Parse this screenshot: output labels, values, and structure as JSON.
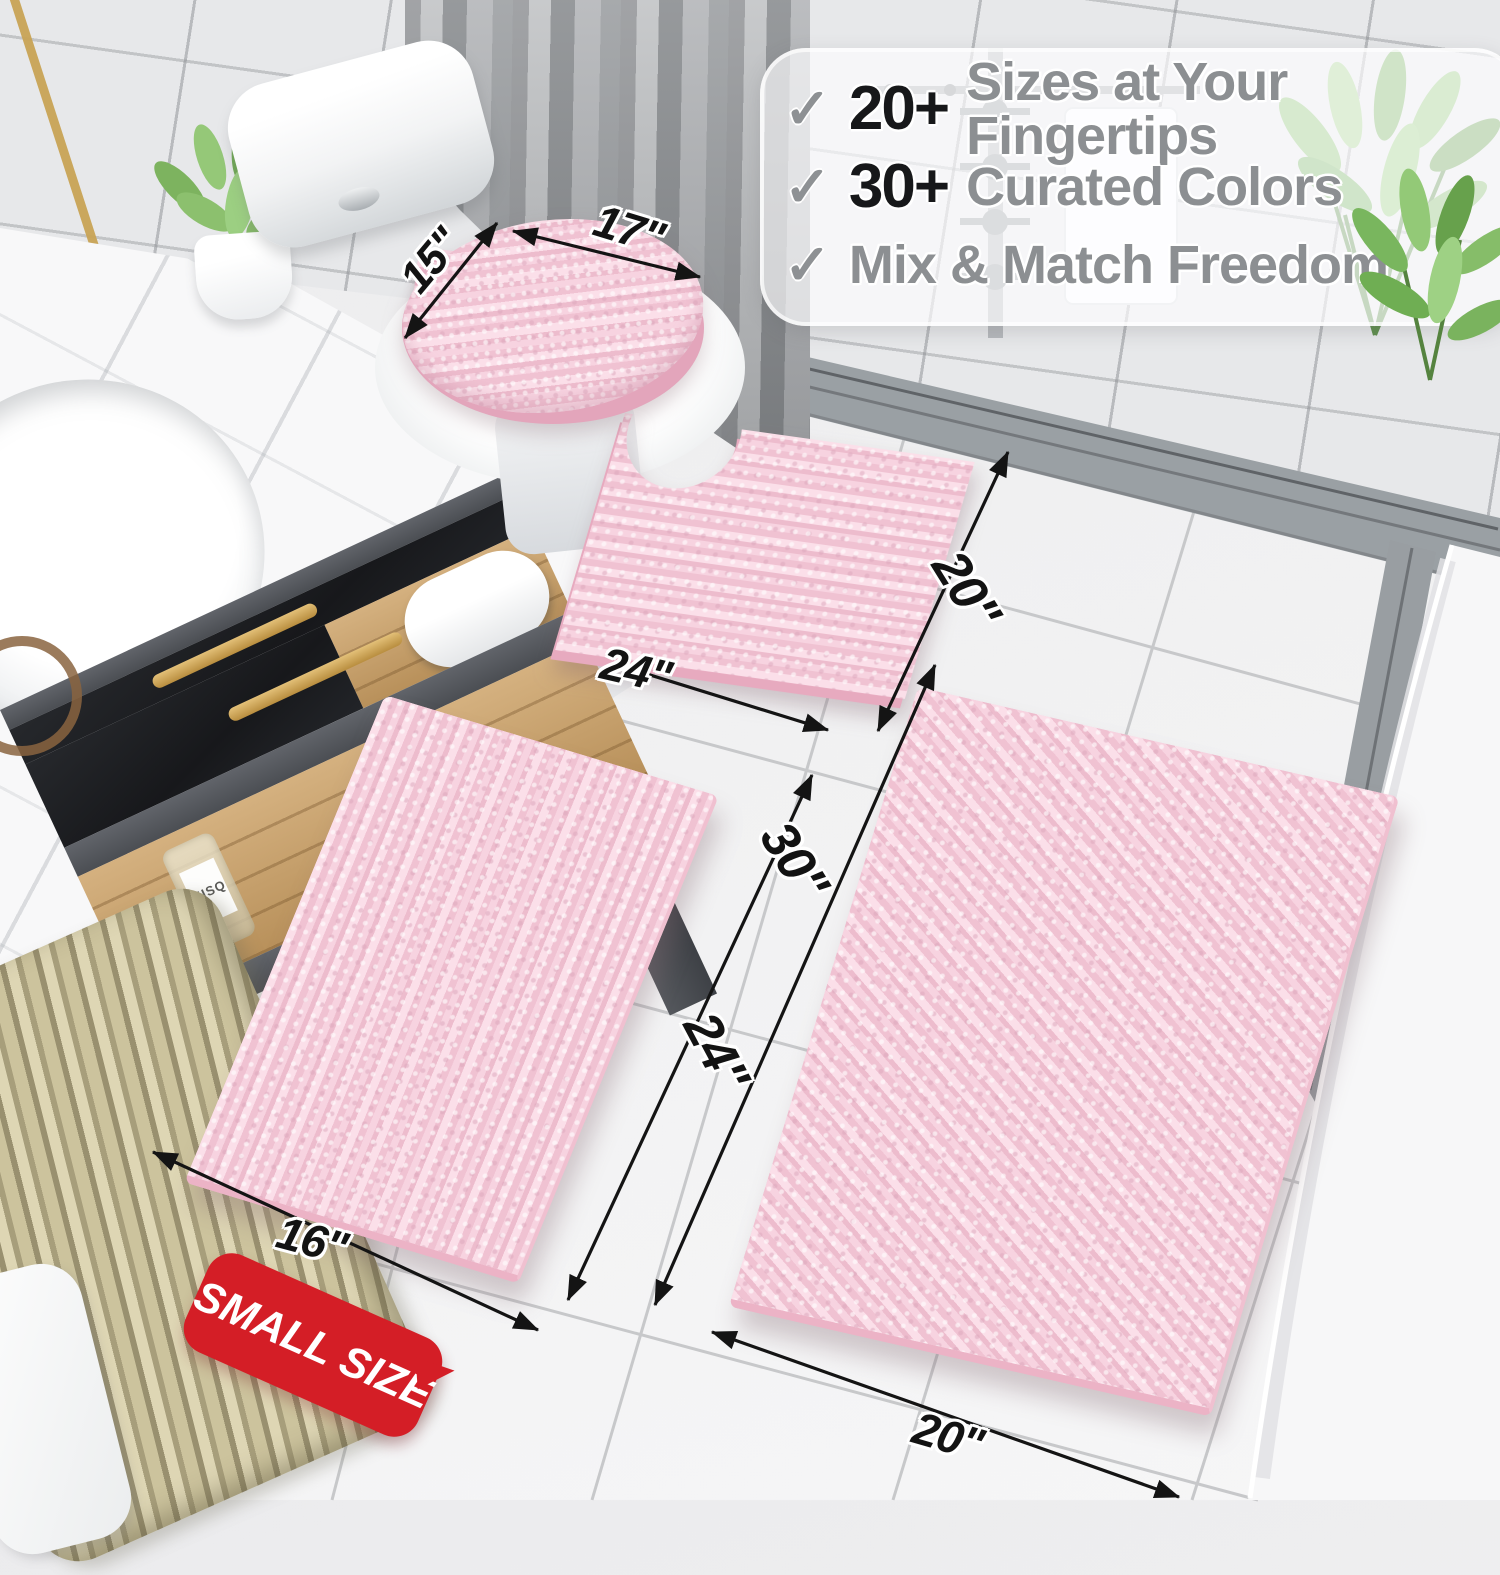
{
  "callout": {
    "items": [
      {
        "check": "✓",
        "stat": "20+",
        "label": "Sizes at Your Fingertips"
      },
      {
        "check": "✓",
        "stat": "30+",
        "label": "Curated Colors"
      },
      {
        "check": "✓",
        "stat": "",
        "label": "Mix & Match Freedom"
      }
    ]
  },
  "dimensions": {
    "lid_depth": "15\"",
    "lid_width": "17\"",
    "contour_width": "24\"",
    "contour_depth": "20\"",
    "large_rug_length": "30\"",
    "small_rug_length": "24\"",
    "small_rug_width": "16\"",
    "large_rug_width": "20\""
  },
  "badge": {
    "label": "SMALL SIZE"
  },
  "vanity": {
    "bottle_label": "MISQ"
  },
  "colors": {
    "rug_pink": "#f4cfdc",
    "badge_red": "#d41e26",
    "gold_accent": "#c9a04f",
    "check_gray": "#8e9194",
    "arrow_black": "#141414"
  }
}
